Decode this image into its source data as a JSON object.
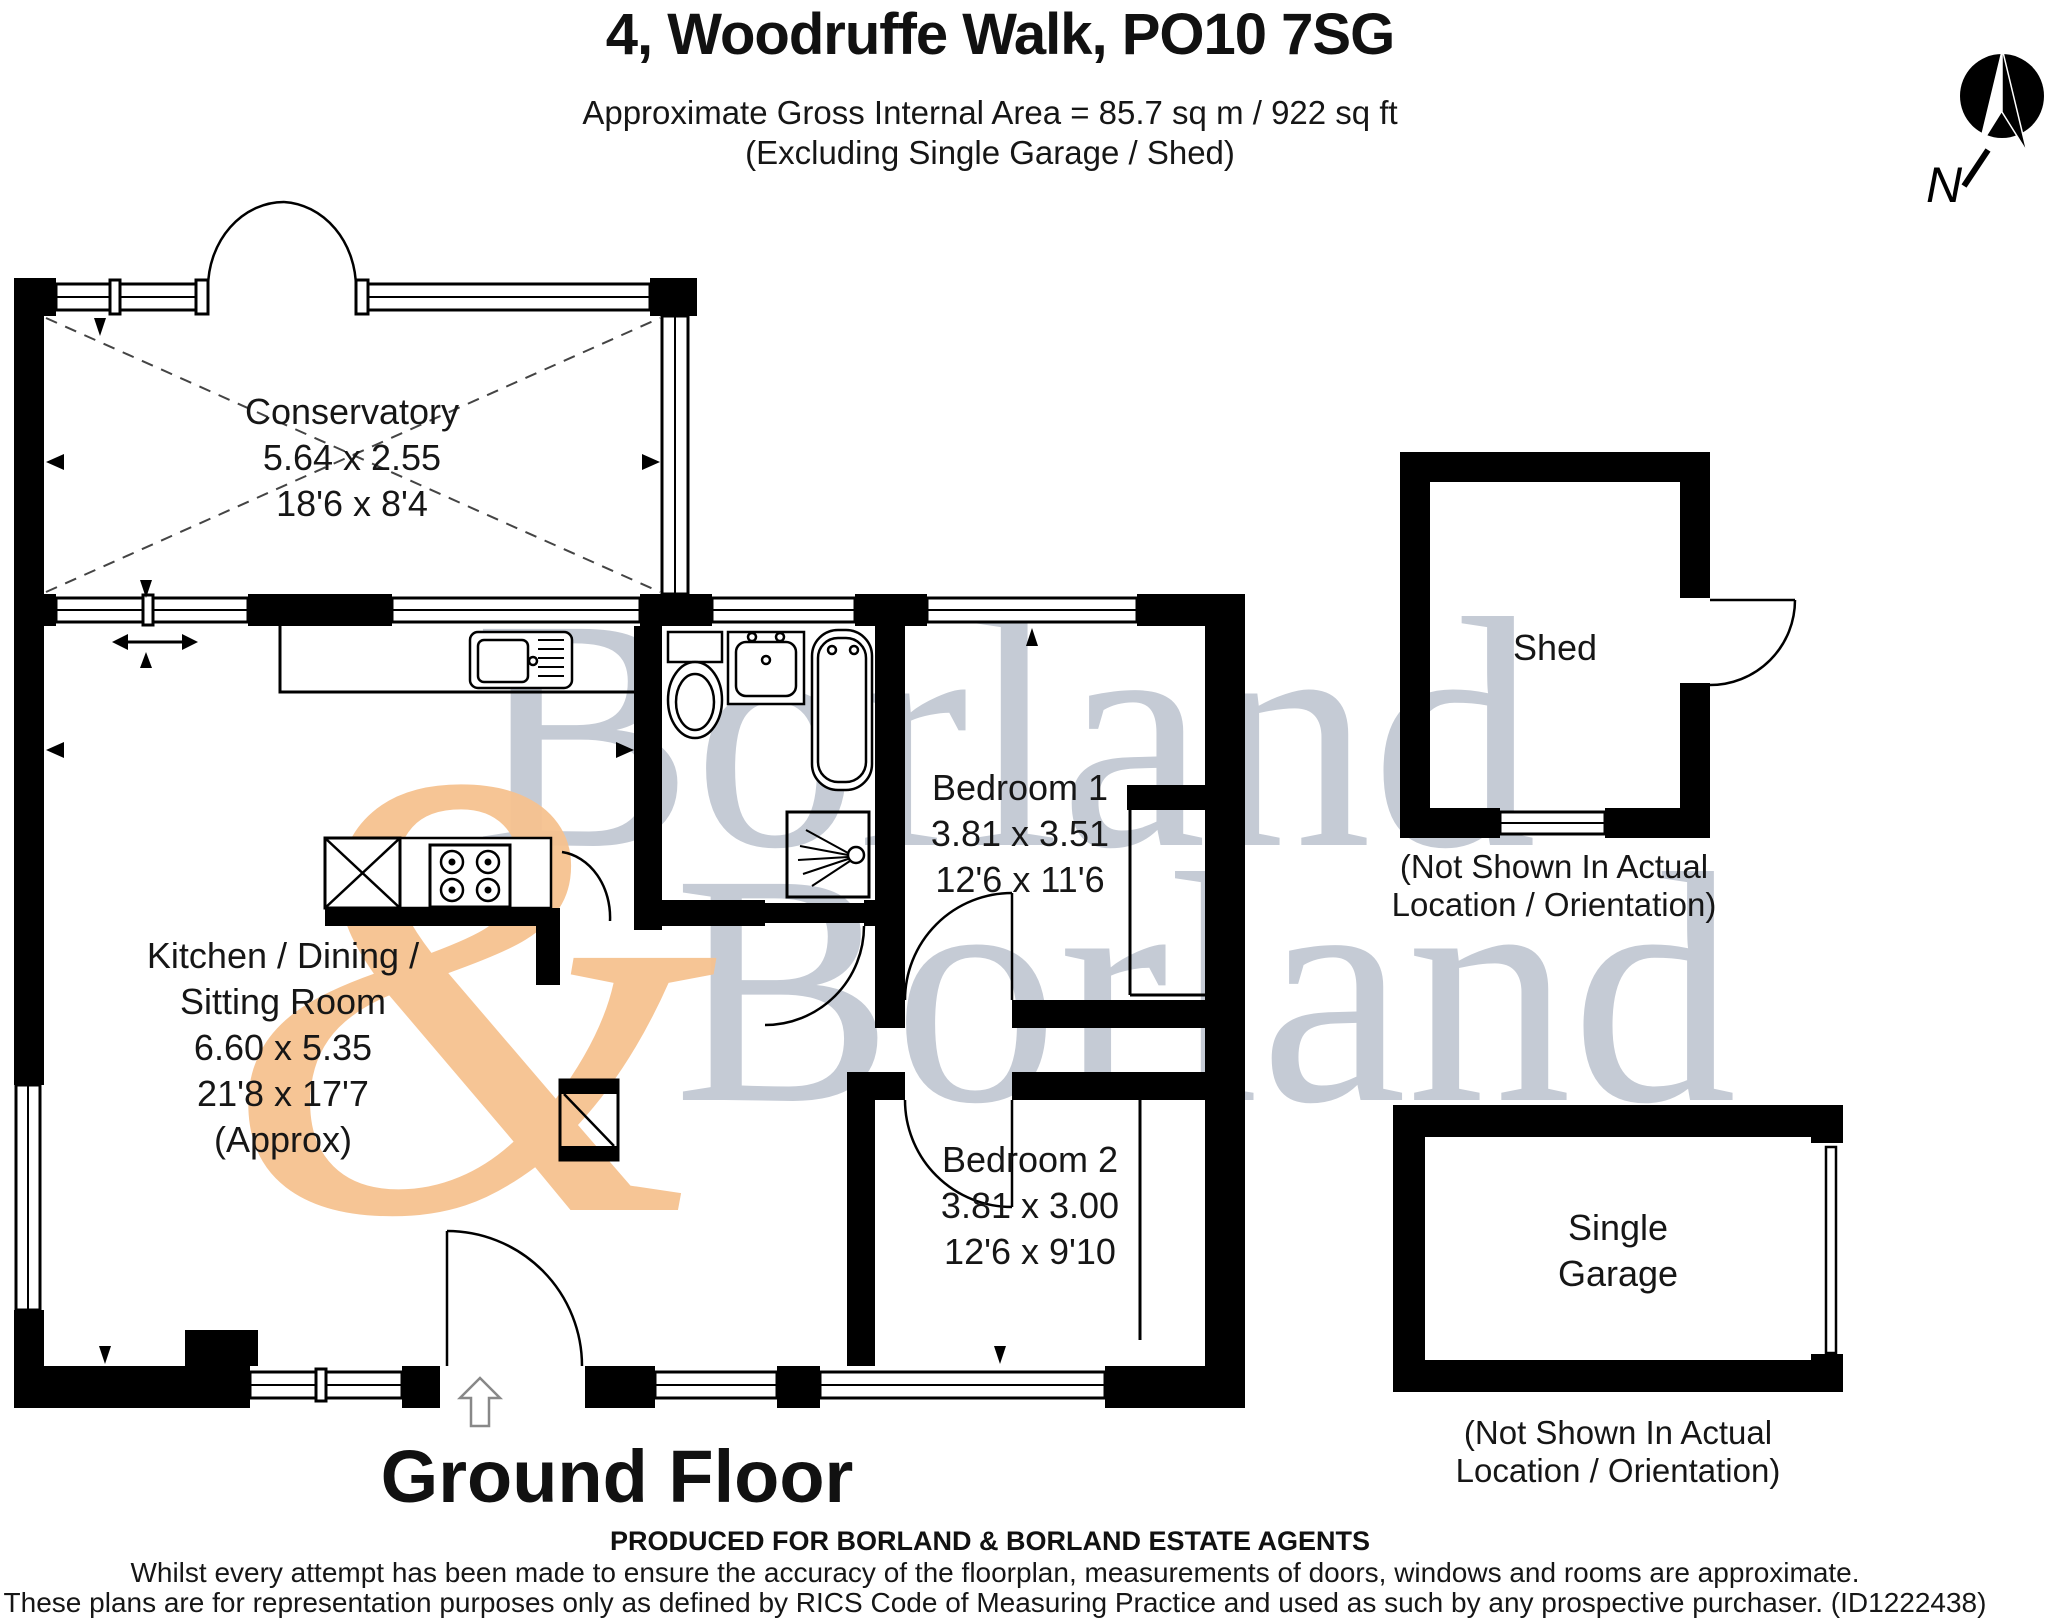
{
  "header": {
    "title": "4, Woodruffe Walk, PO10 7SG",
    "subtitle_line1": "Approximate Gross Internal Area = 85.7 sq m / 922 sq ft",
    "subtitle_line2": "(Excluding Single Garage / Shed)"
  },
  "compass": {
    "label": "N"
  },
  "watermark": {
    "word1": "Borland",
    "ampersand": "&",
    "word2": "Borland"
  },
  "rooms": {
    "conservatory": {
      "name": "Conservatory",
      "size_metric": "5.64 x 2.55",
      "size_imperial": "18'6 x 8'4"
    },
    "kitchen": {
      "name_line1": "Kitchen / Dining /",
      "name_line2": "Sitting Room",
      "size_metric": "6.60 x 5.35",
      "size_imperial": "21'8 x 17'7",
      "qualifier": "(Approx)"
    },
    "bedroom1": {
      "name": "Bedroom 1",
      "size_metric": "3.81 x 3.51",
      "size_imperial": "12'6 x 11'6"
    },
    "bedroom2": {
      "name": "Bedroom 2",
      "size_metric": "3.81 x 3.00",
      "size_imperial": "12'6 x 9'10"
    },
    "shed": {
      "name": "Shed",
      "note_line1": "(Not Shown In Actual",
      "note_line2": "Location / Orientation)"
    },
    "garage": {
      "name_line1": "Single",
      "name_line2": "Garage",
      "note_line1": "(Not Shown In Actual",
      "note_line2": "Location / Orientation)"
    }
  },
  "floor_label": "Ground Floor",
  "footer": {
    "line1": "PRODUCED FOR BORLAND & BORLAND ESTATE AGENTS",
    "line2": "Whilst every attempt has been made to ensure the accuracy of the floorplan, measurements of doors, windows and rooms are approximate.",
    "line3": "These plans are for representation purposes only as defined by RICS Code of Measuring Practice and used as such by any prospective purchaser. (ID1222438)"
  },
  "colors": {
    "wall": "#000000",
    "background": "#ffffff",
    "watermark_gray": "#c5cbd5",
    "watermark_orange": "#f6c290"
  }
}
